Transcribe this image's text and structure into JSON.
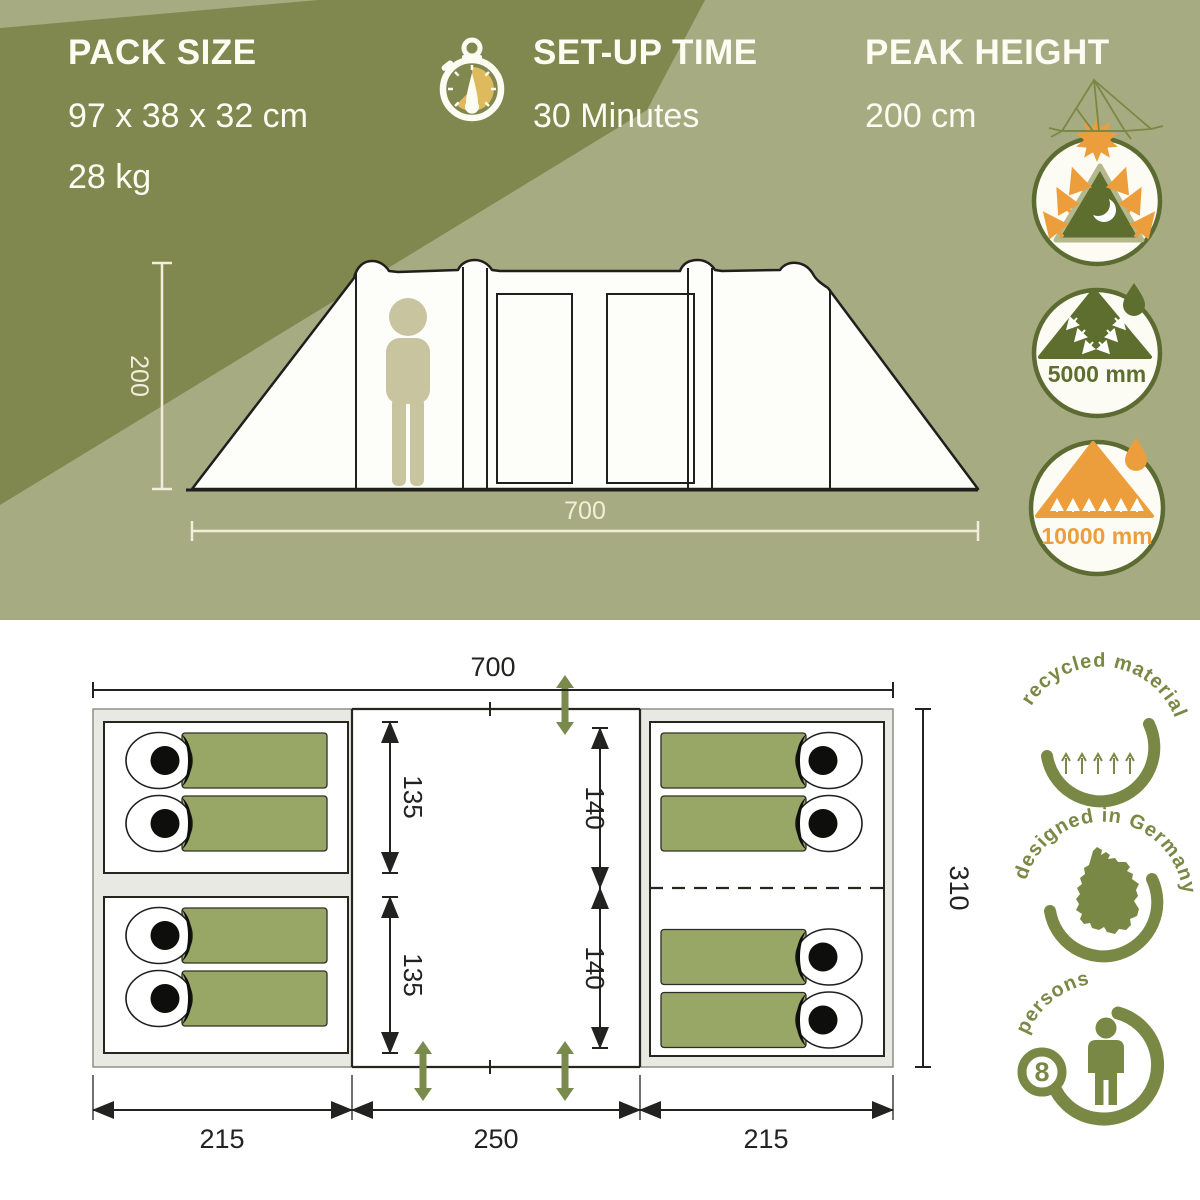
{
  "specs": {
    "pack_size": {
      "title": "PACK SIZE",
      "dimensions": "97 x 38 x 32 cm",
      "weight": "28 kg"
    },
    "setup_time": {
      "title": "SET-UP TIME",
      "value": "30 Minutes"
    },
    "peak_height": {
      "title": "PEAK HEIGHT",
      "value": "200 cm"
    }
  },
  "side_view": {
    "height_cm": "200",
    "width_cm": "700"
  },
  "feature_badges": {
    "flysheet_water_column": "5000 mm",
    "groundsheet_water_column": "10000 mm"
  },
  "floor_plan": {
    "total_width": "700",
    "total_depth": "310",
    "left_cabin_width": "215",
    "vestibule_width": "250",
    "right_cabin_width": "215",
    "left_room_depth_upper": "135",
    "left_room_depth_lower": "135",
    "right_room_depth_upper": "140",
    "right_room_depth_lower": "140"
  },
  "quality_badges": {
    "recycled_material": "recycled material",
    "designed_in_germany": "designed in Germany",
    "persons_label": "persons",
    "persons_count": "8"
  },
  "icons": {
    "stopwatch": "stopwatch-icon",
    "sun_reflection_tent": "sun-reflection-darkened-cabin-icon",
    "flysheet_rain_tent": "flysheet-waterproof-icon",
    "groundsheet_tent": "groundsheet-waterproof-icon",
    "recycled_tent": "recycled-tent-line-icon",
    "germany_map": "germany-map-icon",
    "person": "person-pictogram-icon",
    "door_arrow": "door-direction-arrow-icon"
  },
  "colors": {
    "dark_olive": "#80884F",
    "light_sage": "#A7AB81",
    "cream": "#F1EFDC",
    "text_white": "#FCFCF2",
    "accent_yellow": "#DFB95E",
    "accent_orange": "#ED9E3C",
    "badge_green": "#5D6E2F",
    "bag_green": "#98A666",
    "bottom_badge_olive": "#7A8845"
  }
}
